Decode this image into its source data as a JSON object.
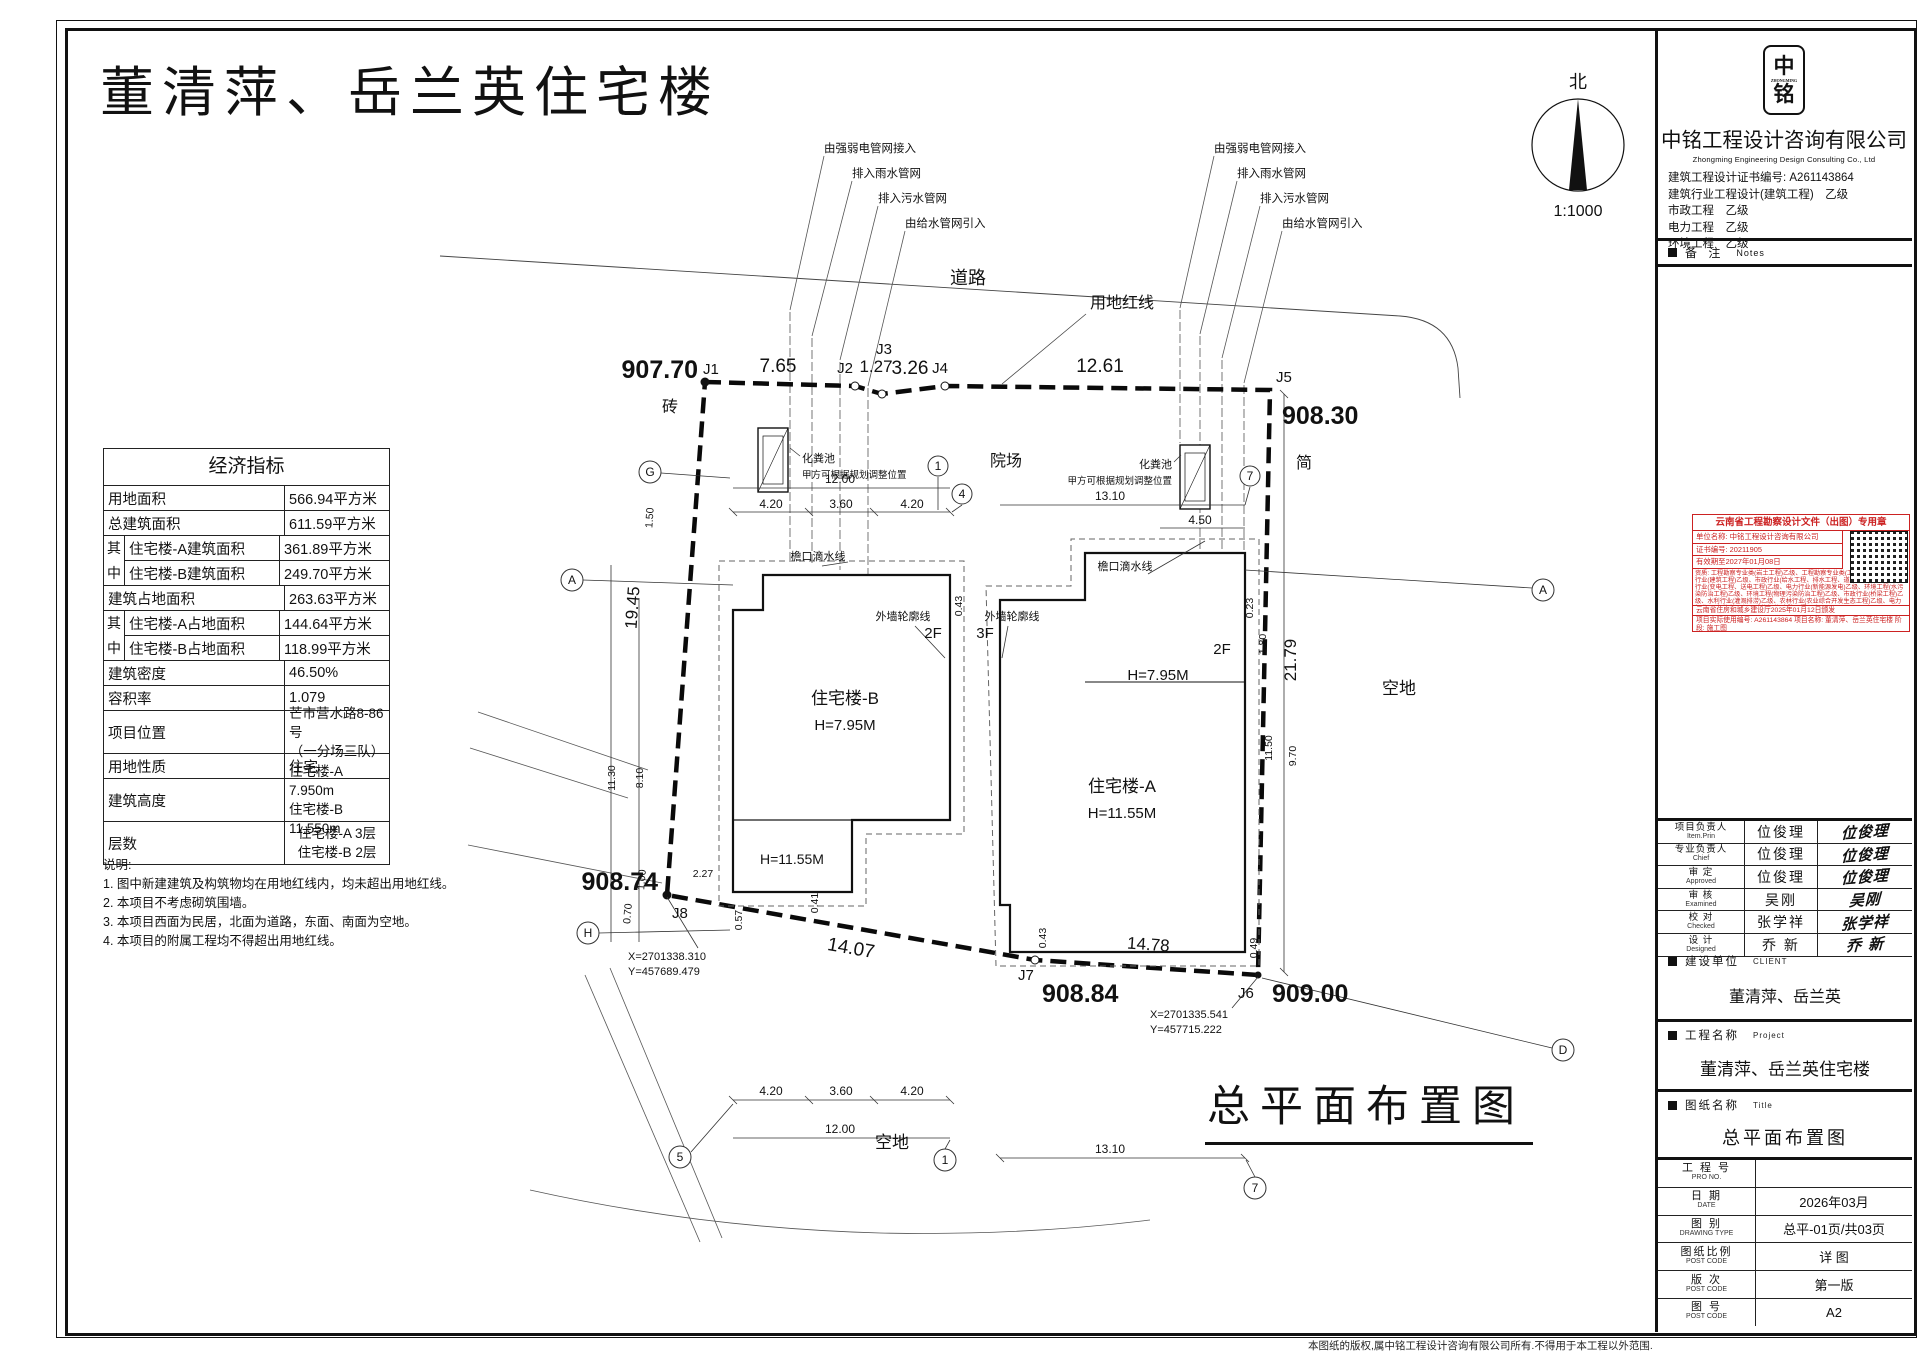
{
  "sheet": {
    "title": "董清萍、岳兰英住宅楼",
    "big_title": "总平面布置图",
    "north_label": "北",
    "scale": "1:1000"
  },
  "econ": {
    "header": "经济指标",
    "group1": "其",
    "group2": "中",
    "rows": [
      {
        "label": "用地面积",
        "value": "566.94平方米"
      },
      {
        "label": "总建筑面积",
        "value": "611.59平方米"
      },
      {
        "label": "住宅楼-A建筑面积",
        "value": "361.89平方米"
      },
      {
        "label": "住宅楼-B建筑面积",
        "value": "249.70平方米"
      },
      {
        "label": "建筑占地面积",
        "value": "263.63平方米"
      },
      {
        "label": "住宅楼-A占地面积",
        "value": "144.64平方米"
      },
      {
        "label": "住宅楼-B占地面积",
        "value": "118.99平方米"
      },
      {
        "label": "建筑密度",
        "value": "46.50%"
      },
      {
        "label": "容积率",
        "value": "1.079"
      },
      {
        "label": "项目位置",
        "value": "芒市营水路8-86号",
        "value2": "（一分场三队）"
      },
      {
        "label": "用地性质",
        "value": "住宅"
      },
      {
        "label": "建筑高度",
        "value": "住宅楼-A 7.950m",
        "value2": "住宅楼-B 11.550m"
      },
      {
        "label": "层数",
        "value": "住宅楼-A 3层",
        "value2": "住宅楼-B 2层"
      }
    ]
  },
  "notes": {
    "title": "说明:",
    "items": [
      "1. 图中新建建筑及构筑物均在用地红线内，均未超出用地红线。",
      "2. 本项目不考虑砌筑围墙。",
      "3. 本项目西面为民居，北面为道路，东面、南面为空地。",
      "4. 本项目的附属工程均不得超出用地红线。"
    ]
  },
  "plan": {
    "labels": {
      "road": "道路",
      "redline": "用地红线",
      "yard": "院场",
      "open_east": "空地",
      "open_south": "空地",
      "brick": "砖",
      "jian": "简"
    },
    "spots": {
      "j1": "907.70",
      "j5": "908.30",
      "j8": "908.74",
      "j7": "908.84",
      "j6": "909.00"
    },
    "pts": {
      "j1": "J1",
      "j2": "J2",
      "j3": "J3",
      "j4": "J4",
      "j5": "J5",
      "j6": "J6",
      "j7": "J7",
      "j8": "J8"
    },
    "dims": {
      "d1": "7.65",
      "d2": "1.27",
      "d3": "3.26",
      "d4": "12.61",
      "left": "19.45",
      "right": "21.79",
      "b1": "14.07",
      "b2": "14.78",
      "c1200": "12.00",
      "c420": "4.20",
      "c360": "3.60",
      "c1310": "13.10",
      "c450": "4.50",
      "s150": "1.50",
      "s1130": "11.30",
      "s810": "8.10",
      "s227": "2.27",
      "s100": "1.00",
      "s070": "0.70",
      "s057": "0.57",
      "s041": "0.41",
      "s043": "0.43",
      "s023": "0.23",
      "s180": "1.80",
      "s1150": "11.50",
      "s970": "9.70",
      "s049": "0.49"
    },
    "bldg": {
      "b_name": "住宅楼-B",
      "b_h": "H=7.95M",
      "b_annex": "H=11.55M",
      "a_name": "住宅楼-A",
      "a_h": "H=11.55M",
      "a_h2": "H=7.95M",
      "f2a": "2F",
      "f3": "3F",
      "f2b": "2F"
    },
    "util": {
      "power": "由强弱电管网接入",
      "rain": "排入雨水管网",
      "sewage": "排入污水管网",
      "water": "由给水管网引入"
    },
    "septic": {
      "name": "化粪池",
      "note": "甲方可根据规划调整位置"
    },
    "lines": {
      "eaves": "檐口滴水线",
      "outline": "外墙轮廓线"
    },
    "coords": {
      "j8x": "X=2701338.310",
      "j8y": "Y=457689.479",
      "j6x": "X=2701335.541",
      "j6y": "Y=457715.222"
    },
    "axis": {
      "g": "G",
      "a": "A",
      "h": "H",
      "a2": "A",
      "d": "D",
      "c1": "1",
      "c4": "4",
      "c7": "7",
      "c5": "5"
    }
  },
  "tb": {
    "company": {
      "logo1": "中",
      "logo2": "铭",
      "logo_sub": "ZHONGMING",
      "name": "中铭工程设计咨询有限公司",
      "en": "Zhongming Engineering Design Consulting Co., Ltd",
      "cert": "建筑工程设计证书编号: A261143864",
      "q1": "建筑行业工程设计(建筑工程)　乙级",
      "q2": "市政工程　乙级",
      "q3": "电力工程　乙级",
      "q4": "环境工程　乙级"
    },
    "notes_bar": {
      "cn": "备 注",
      "en": "Notes"
    },
    "stamp": {
      "title": "云南省工程勘察设计文件（出图）专用章",
      "l1": "单位名称: 中铭工程设计咨询有限公司",
      "l2": "证书编号: 20211905",
      "l3": "有效期至2027年01月08日",
      "para": "资质: 工程勘察专业类(岩土工程)乙级、工程勘察专业类(工程测量)乙级、建筑行业(建筑工程)乙级、市政行业(给水工程、排水工程、道路工程)乙级、电力行业(变电工程、送电工程)乙级、电力行业(新能源发电)乙级、环境工程(水污染防治工程)乙级、环境工程(物理污染防治工程)乙级、市政行业(桥梁工程)乙级、水利行业(灌溉排涝)乙级、农林行业(农业综合开发生态工程)乙级、电力行业(风力发电)乙级、建筑行业(人防工程)乙级",
      "issue": "云南省住房和城乡建设厅2025年01月12日颁发",
      "proj": "项目实际使用编号: A261143864 项目名称: 董清萍、岳兰英住宅楼 阶段: 施工图"
    },
    "personnel": [
      {
        "cn": "项目负责人",
        "en": "Item.Prin",
        "name": "位俊理"
      },
      {
        "cn": "专业负责人",
        "en": "Chief",
        "name": "位俊理"
      },
      {
        "cn": "审 定",
        "en": "Approved",
        "name": "位俊理"
      },
      {
        "cn": "审 核",
        "en": "Examined",
        "name": "吴刚"
      },
      {
        "cn": "校 对",
        "en": "Checked",
        "name": "张学祥"
      },
      {
        "cn": "设 计",
        "en": "Designed",
        "name": "乔 新"
      }
    ],
    "client": {
      "cn": "建设单位",
      "en": "CLIENT",
      "value": "董清萍、岳兰英"
    },
    "project": {
      "cn": "工程名称",
      "en": "Project",
      "value": "董清萍、岳兰英住宅楼"
    },
    "dtitle": {
      "cn": "图纸名称",
      "en": "Title",
      "value": "总平面布置图"
    },
    "foot": [
      {
        "cn": "工 程 号",
        "en": "PRO NO.",
        "value": ""
      },
      {
        "cn": "日  期",
        "en": "DATE",
        "value": "2026年03月"
      },
      {
        "cn": "图  别",
        "en": "DRAWING TYPE",
        "value": "总平-01页/共03页"
      },
      {
        "cn": "图纸比例",
        "en": "POST CODE",
        "value": "详 图"
      },
      {
        "cn": "版  次",
        "en": "POST CODE",
        "value": "第一版"
      },
      {
        "cn": "图  号",
        "en": "POST CODE",
        "value": "A2"
      }
    ],
    "copyright": "本图纸的版权,属中铭工程设计咨询有限公司所有.不得用于本工程以外范围."
  }
}
